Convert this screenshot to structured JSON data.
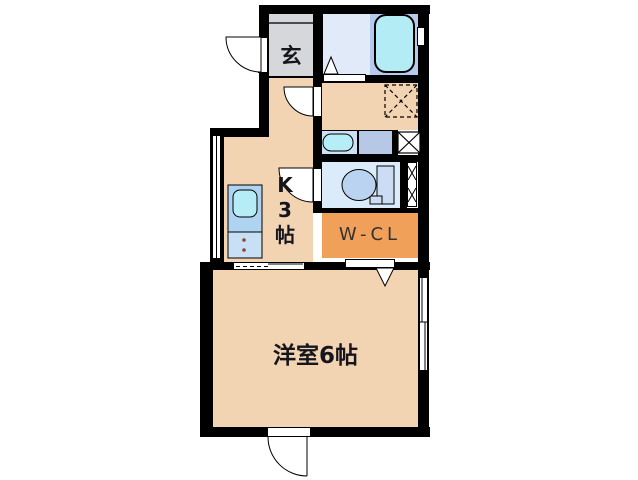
{
  "floorplan": {
    "rooms": {
      "genkan": {
        "label": "玄"
      },
      "kitchen": {
        "label": "K3帖",
        "lines": [
          "K",
          "3",
          "帖"
        ]
      },
      "walk_in_closet": {
        "label": "W-CL"
      },
      "western_room": {
        "label": "洋室6帖"
      }
    },
    "fixtures": [
      "bathtub",
      "bathroom",
      "washbasin",
      "toilet",
      "kitchen-sink",
      "refrigerator-space",
      "pipe-shaft",
      "entrance-door",
      "sliding-door",
      "windows"
    ],
    "colors": {
      "wall": "#000000",
      "floor_tan": "#f2d3b2",
      "genkan_gray": "#d6d7db",
      "bath_floor": "#e0eaf8",
      "tub_surround": "#b6caee",
      "tub_cyan": "#b3ecf5",
      "toilet_floor": "#dcebfa",
      "closet_orange": "#f0a058",
      "counter_blue": "#aed4f2",
      "cabinet_blue": "#c8e0f6",
      "basin_counter": "#cde0f6",
      "basin_side": "#b7c8e6",
      "fixture_cyan": "#b6eef8",
      "toilet_bowl": "#b9d3f0"
    }
  }
}
